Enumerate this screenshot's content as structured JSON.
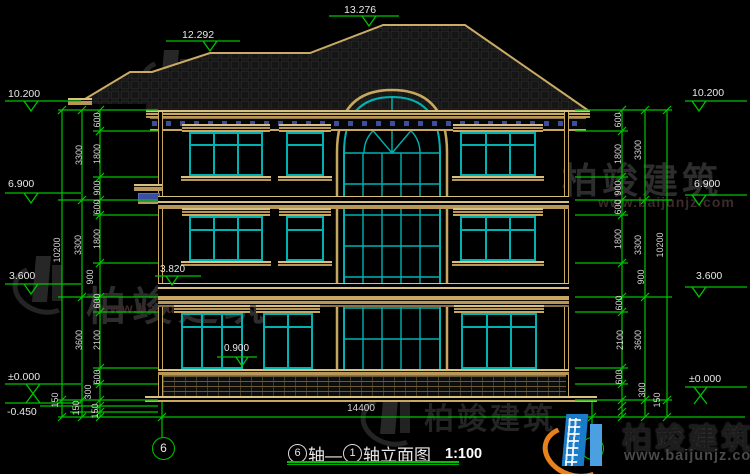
{
  "drawing": {
    "levels_top": [
      "13.276",
      "12.292"
    ],
    "levels_left": [
      "10.200",
      "6.900",
      "3.600",
      "±0.000",
      "-0.450"
    ],
    "levels_right": [
      "10.200",
      "6.900",
      "3.600",
      "±0.000"
    ],
    "levels_inner": [
      "3.820",
      "0.900"
    ],
    "dims": {
      "left_inner": [
        "600",
        "1800",
        "900",
        "600",
        "1800",
        "900",
        "600",
        "2100",
        "600",
        "300",
        "150",
        "150",
        "150"
      ],
      "left_middle": [
        "3300",
        "3300",
        "3600"
      ],
      "left_outer": [
        "10200"
      ],
      "right_inner": [
        "600",
        "1800",
        "900",
        "600",
        "1800",
        "900",
        "600",
        "2100",
        "600",
        "300",
        "150"
      ],
      "right_middle": [
        "3300",
        "3300",
        "3600"
      ],
      "right_outer": [
        "10200"
      ],
      "bottom_total": "14400"
    },
    "axis_bubbles": {
      "left": "6",
      "right": "1"
    },
    "title": {
      "bubble_start": "6",
      "seg1": "轴—",
      "bubble_end": "1",
      "seg2": "轴立面图",
      "scale": "1:100"
    }
  },
  "watermark": {
    "brand": "柏竣建筑",
    "url": "www.baijunjz.com"
  },
  "logo": {
    "brand": "柏竣建筑",
    "url": "www.baijunjz.com"
  }
}
